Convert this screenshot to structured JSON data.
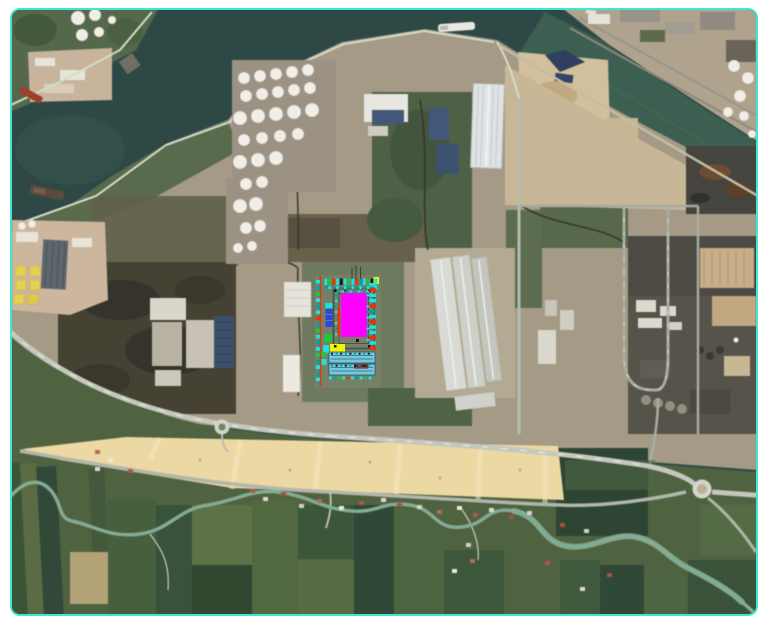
{
  "scene": {
    "type": "satellite-map",
    "description": "Aerial satellite view of a coastal industrial port area with canals, tank farms, warehouses, a power plant, a highway, reclaimed sand strip, meandering river and farmland; a colored CAD site-layout plan is overlaid near the center",
    "border_color": "#3ee6d6",
    "background": "#ffffff"
  },
  "map_palette": {
    "water": "#2d4945",
    "water_canal": "#3f6354",
    "island": "#a49a84",
    "mainland": "#4e6340",
    "sand": "#ecd8a0",
    "river": "#83ab92",
    "road_main": "#c3c7bd",
    "road_minor": "#b2b6ab",
    "vegetation": "#50633f",
    "scrub": "#464232",
    "tank": "#f0eee6",
    "plant": "#55534a",
    "quay": "#c8b795"
  },
  "overlay_palette": {
    "magenta": "#ff00ff",
    "yellow": "#f2f500",
    "cyan": "#19e4e4",
    "teal": "#0a9f9f",
    "green": "#21c63e",
    "red": "#ef2f06",
    "blue": "#2a46e8",
    "darkred": "#8f1a10",
    "black": "#141414",
    "basin": "#74c9de",
    "frame": "#49523f",
    "redline": "#e03508"
  },
  "overlay": {
    "name": "site-layout-plan",
    "frame": {
      "x": 333.5,
      "y": 288.5,
      "w": 40.5,
      "h": 60
    },
    "inner_frame": {
      "x": 339,
      "y": 293.5,
      "w": 29.5,
      "h": 50
    },
    "red_line": {
      "x": 320.3,
      "y0": 276,
      "y1": 386
    },
    "blocks": [
      {
        "name": "main-building",
        "x": 341,
        "y": 293,
        "w": 26,
        "h": 44,
        "c": "magenta"
      },
      {
        "name": "red-riser",
        "x": 337.4,
        "y": 307,
        "w": 2.6,
        "h": 29,
        "c": "red"
      },
      {
        "name": "yellow-building",
        "x": 330,
        "y": 344,
        "w": 15,
        "h": 9,
        "c": "yellow"
      },
      {
        "name": "cyan-unit-a",
        "x": 323,
        "y": 345,
        "w": 6,
        "h": 8,
        "c": "cyan"
      },
      {
        "name": "green-unit",
        "x": 324,
        "y": 334,
        "w": 8,
        "h": 8,
        "c": "green"
      },
      {
        "name": "cyan-unit-b",
        "x": 325.5,
        "y": 303,
        "w": 7,
        "h": 5,
        "c": "cyan"
      },
      {
        "name": "blue-unit-1",
        "x": 325.5,
        "y": 309,
        "w": 7,
        "h": 5,
        "c": "blue"
      },
      {
        "name": "blue-unit-2",
        "x": 325.5,
        "y": 315,
        "w": 7,
        "h": 5,
        "c": "blue"
      },
      {
        "name": "blue-unit-3",
        "x": 325.5,
        "y": 321,
        "w": 7,
        "h": 6,
        "c": "blue"
      },
      {
        "name": "green-unit-b",
        "x": 321.5,
        "y": 352,
        "w": 5,
        "h": 5,
        "c": "green"
      },
      {
        "name": "cyan-unit-c",
        "x": 321.5,
        "y": 359,
        "w": 5,
        "h": 6,
        "c": "cyan"
      },
      {
        "name": "basin-1",
        "x": 329,
        "y": 352,
        "w": 46,
        "h": 11,
        "c": "basin"
      },
      {
        "name": "basin-2",
        "x": 329,
        "y": 364,
        "w": 46,
        "h": 11,
        "c": "basin"
      },
      {
        "name": "basin-red-bar",
        "x": 354,
        "y": 364.5,
        "w": 14,
        "h": 4,
        "c": "darkred"
      },
      {
        "name": "yellow-corner",
        "x": 373.5,
        "y": 277,
        "w": 5.5,
        "h": 7,
        "c": "yellow"
      },
      {
        "name": "dot-1",
        "x": 334,
        "y": 289.5,
        "w": 2.5,
        "h": 2.5,
        "c": "black"
      },
      {
        "name": "dot-2",
        "x": 368,
        "y": 289.5,
        "w": 2.5,
        "h": 2.5,
        "c": "black"
      },
      {
        "name": "dot-3",
        "x": 334,
        "y": 345,
        "w": 2.5,
        "h": 2.5,
        "c": "black"
      },
      {
        "name": "dot-4",
        "x": 368,
        "y": 345,
        "w": 2.5,
        "h": 2.5,
        "c": "black"
      },
      {
        "name": "dot-5",
        "x": 356,
        "y": 339,
        "w": 3,
        "h": 3,
        "c": "black"
      },
      {
        "name": "dot-6",
        "x": 344.5,
        "y": 289.8,
        "w": 2,
        "h": 2,
        "c": "black"
      }
    ],
    "tick_rows": [
      {
        "name": "top-row-upper",
        "dir": "h",
        "x0": 324.5,
        "y": 278.5,
        "dx": 3.85,
        "count": 14,
        "w": 2.7,
        "h": 6.5,
        "colors": [
          "cyan",
          "green",
          "red",
          "cyan",
          "black",
          "cyan",
          "green",
          "cyan",
          "red",
          "teal",
          "cyan",
          "green",
          "black",
          "cyan"
        ]
      },
      {
        "name": "top-row-lower",
        "dir": "h",
        "x0": 324.5,
        "y": 286,
        "dx": 3.85,
        "count": 14,
        "w": 2.7,
        "h": 3,
        "colors": [
          "teal",
          "cyan"
        ]
      },
      {
        "name": "left-column",
        "dir": "v",
        "x": 315.8,
        "y0": 280,
        "dy": 6.1,
        "count": 17,
        "w": 4.3,
        "h": 3.6,
        "colors": [
          "cyan",
          "teal",
          "green",
          "cyan",
          "teal",
          "cyan",
          "red",
          "teal",
          "green",
          "cyan",
          "teal",
          "cyan",
          "green",
          "teal",
          "cyan",
          "teal",
          "cyan"
        ]
      },
      {
        "name": "right-column",
        "dir": "v",
        "x": 369.5,
        "y0": 283,
        "dy": 5.3,
        "count": 13,
        "w": 6.4,
        "h": 3.4,
        "colors": [
          "cyan",
          "red",
          "cyan",
          "cyan",
          "red",
          "teal",
          "cyan",
          "red",
          "cyan",
          "cyan",
          "red",
          "cyan",
          "red"
        ]
      },
      {
        "name": "frame-left-ticks",
        "dir": "v",
        "x": 335,
        "y0": 294,
        "dy": 5.6,
        "count": 9,
        "w": 2.5,
        "h": 2.3,
        "colors": [
          "teal",
          "cyan"
        ]
      },
      {
        "name": "frame-right-ticks",
        "dir": "v",
        "x": 366.6,
        "y0": 294,
        "dy": 5.6,
        "count": 9,
        "w": 2.5,
        "h": 2.3,
        "colors": [
          "cyan",
          "teal"
        ]
      },
      {
        "name": "frame-top-ticks",
        "dir": "h",
        "x0": 337,
        "y": 290.5,
        "dx": 4.2,
        "count": 8,
        "w": 2.5,
        "h": 2.2,
        "colors": [
          "teal",
          "cyan"
        ]
      },
      {
        "name": "basin1-marks",
        "dir": "h",
        "x0": 331,
        "y": 352.8,
        "dx": 4.6,
        "count": 9,
        "w": 2,
        "h": 1.8,
        "colors": [
          "black",
          "teal"
        ]
      },
      {
        "name": "basin2-marks",
        "dir": "h",
        "x0": 331,
        "y": 364.8,
        "dx": 4.6,
        "count": 9,
        "w": 2,
        "h": 1.8,
        "colors": [
          "teal",
          "black"
        ]
      },
      {
        "name": "bottom-row",
        "dir": "h",
        "x0": 329,
        "y": 376.5,
        "dx": 4.4,
        "count": 10,
        "w": 2.8,
        "h": 3,
        "colors": [
          "cyan",
          "teal",
          "green",
          "cyan",
          "red",
          "cyan",
          "teal",
          "cyan",
          "green",
          "cyan"
        ]
      }
    ],
    "antennae": [
      {
        "x": 352,
        "y0": 268,
        "y1": 279
      },
      {
        "x": 356,
        "y0": 265,
        "y1": 279
      },
      {
        "x": 360.5,
        "y0": 267,
        "y1": 279
      }
    ]
  },
  "map_detail": {
    "house_colors": [
      "#b2584a",
      "#e0dacd",
      "#a85044",
      "#d8d2c4",
      "#bb6a52",
      "#ece7db"
    ],
    "houses": [
      [
        250,
        489
      ],
      [
        263,
        497
      ],
      [
        281,
        492
      ],
      [
        299,
        504
      ],
      [
        317,
        499
      ],
      [
        339,
        506
      ],
      [
        359,
        501
      ],
      [
        381,
        498
      ],
      [
        397,
        503
      ],
      [
        417,
        505
      ],
      [
        437,
        510
      ],
      [
        457,
        506
      ],
      [
        473,
        513
      ],
      [
        489,
        508
      ],
      [
        509,
        515
      ],
      [
        527,
        511
      ],
      [
        95,
        450
      ],
      [
        108,
        458
      ],
      [
        128,
        469
      ],
      [
        95,
        467
      ],
      [
        560,
        523
      ],
      [
        584,
        529
      ],
      [
        470,
        559
      ],
      [
        452,
        569
      ],
      [
        545,
        561
      ],
      [
        580,
        587
      ],
      [
        607,
        573
      ],
      [
        466,
        543
      ]
    ],
    "tanks_west": [
      [
        244,
        78,
        6
      ],
      [
        260,
        76,
        6
      ],
      [
        276,
        74,
        6
      ],
      [
        292,
        72,
        6
      ],
      [
        308,
        70,
        6
      ],
      [
        246,
        96,
        6
      ],
      [
        262,
        94,
        6
      ],
      [
        278,
        92,
        6
      ],
      [
        294,
        90,
        6
      ],
      [
        310,
        88,
        6
      ],
      [
        240,
        118,
        7
      ],
      [
        258,
        116,
        7
      ],
      [
        276,
        114,
        7
      ],
      [
        294,
        112,
        7
      ],
      [
        312,
        110,
        7
      ],
      [
        244,
        140,
        6
      ],
      [
        262,
        138,
        6
      ],
      [
        280,
        136,
        6
      ],
      [
        298,
        134,
        6
      ],
      [
        240,
        162,
        7
      ],
      [
        258,
        160,
        7
      ],
      [
        276,
        158,
        7
      ],
      [
        246,
        184,
        6
      ],
      [
        262,
        182,
        6
      ],
      [
        240,
        206,
        7
      ],
      [
        256,
        204,
        7
      ],
      [
        246,
        228,
        6
      ],
      [
        260,
        226,
        6
      ],
      [
        238,
        248,
        5
      ],
      [
        252,
        246,
        5
      ]
    ],
    "tanks_northeast": [
      [
        734,
        66,
        6
      ],
      [
        748,
        78,
        6
      ],
      [
        740,
        96,
        6
      ],
      [
        728,
        112,
        5
      ],
      [
        744,
        116,
        5
      ],
      [
        752,
        134,
        4
      ]
    ],
    "tanks_corner": [
      [
        78,
        18,
        7
      ],
      [
        95,
        15,
        6
      ],
      [
        82,
        35,
        6
      ],
      [
        99,
        32,
        5
      ],
      [
        112,
        20,
        4
      ],
      [
        22,
        226,
        4
      ],
      [
        32,
        224,
        4
      ]
    ],
    "features": [
      "industrial-canal",
      "harbor-water",
      "tank-farm",
      "ribbed-warehouse",
      "cargo-ship",
      "industrial-island",
      "power-plant",
      "coal-yard",
      "highway",
      "roundabout",
      "sand-reclamation-strip",
      "meandering-river",
      "farm-fields",
      "village-houses",
      "site-layout-overlay",
      "yellow-basin-facility",
      "solar-roof-buildings"
    ]
  }
}
